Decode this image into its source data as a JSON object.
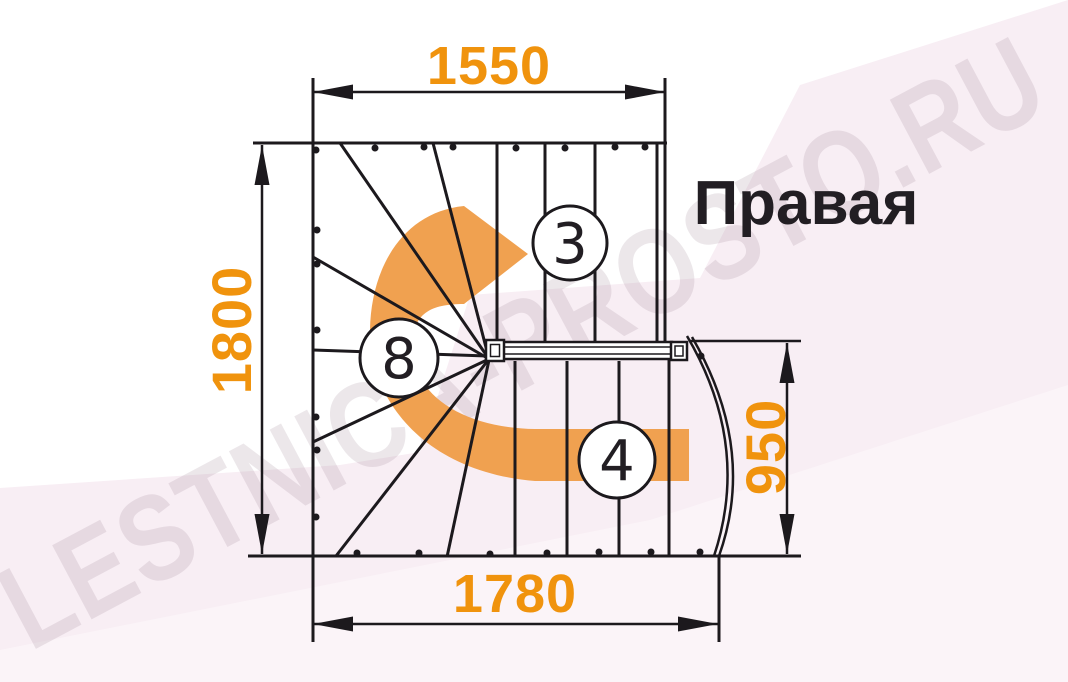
{
  "title": {
    "text": "Правая"
  },
  "dimensions": {
    "top": "1550",
    "left": "1800",
    "right": "950",
    "bottom": "1780"
  },
  "steps": {
    "top_flight": "3",
    "winders": "8",
    "bottom_flight": "4"
  },
  "watermark": {
    "text": "LESTNICA-PROSTO.RU"
  },
  "colors": {
    "line": "#1C191D",
    "dimension": "#F0930D",
    "arrow": "#F0A150",
    "title": "#221E23",
    "bg_pink": "#F8EEF4",
    "bg_pink_light": "#FBF4F8",
    "watermark": "#8D7284"
  }
}
